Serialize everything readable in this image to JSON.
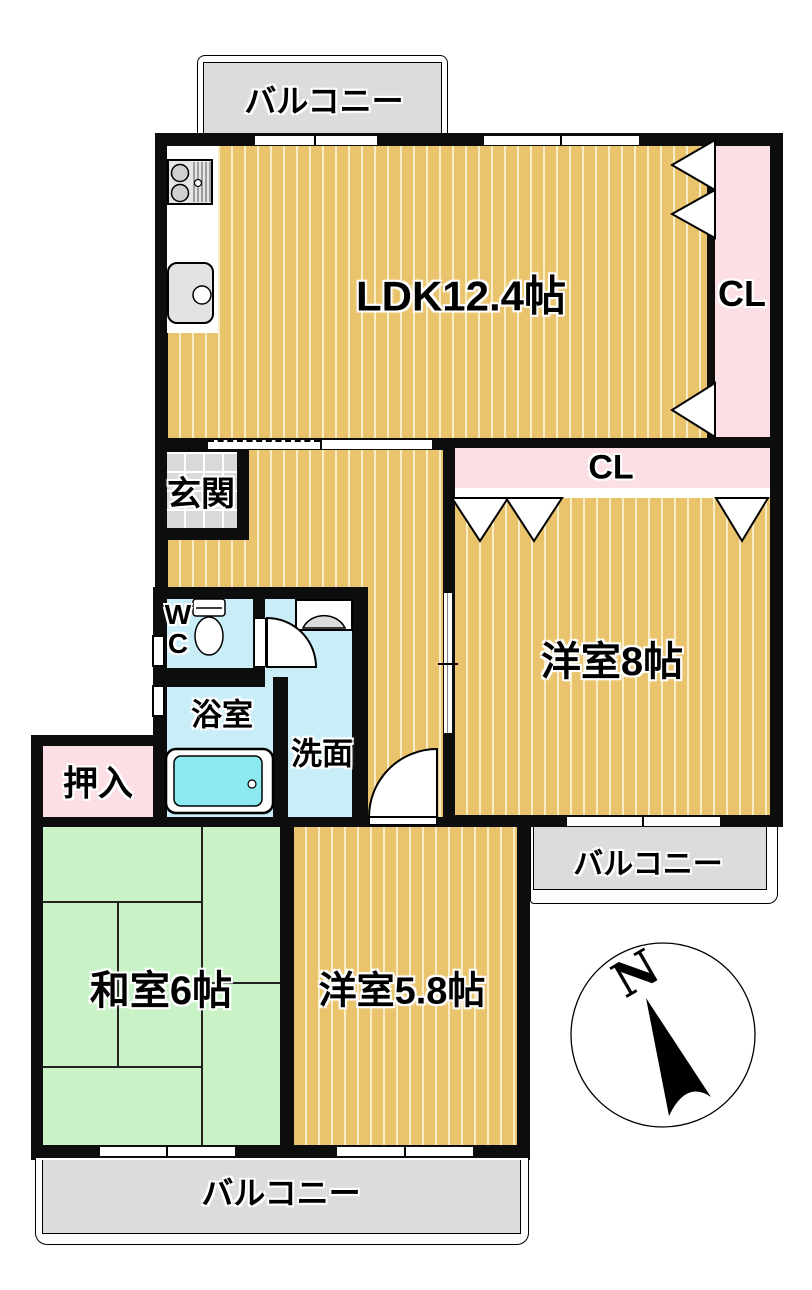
{
  "plan": {
    "balcony_top": "バルコニー",
    "balcony_right": "バルコニー",
    "balcony_bottom": "バルコニー",
    "ldk": "LDK12.4帖",
    "closet_right": "CL",
    "closet_hall": "CL",
    "entrance": "玄関",
    "western_room_8": "洋室8帖",
    "toilet": "WC",
    "bathroom": "浴室",
    "washroom": "洗面",
    "oshiire_closet": "押入",
    "japanese_room_6": "和室6帖",
    "western_room_58": "洋室5.8帖",
    "compass_north": "N"
  },
  "colors": {
    "wall": "#0d0d0d",
    "floor": "#eac46c",
    "floor-stripe": "#f9edc8",
    "tatami": "#c9f2c6",
    "wet": "#c9eef8",
    "tub": "#8ce9f2",
    "closet": "#fcdfe4",
    "balcony": "#dcdcdc",
    "tile": "#d9d9d9"
  }
}
